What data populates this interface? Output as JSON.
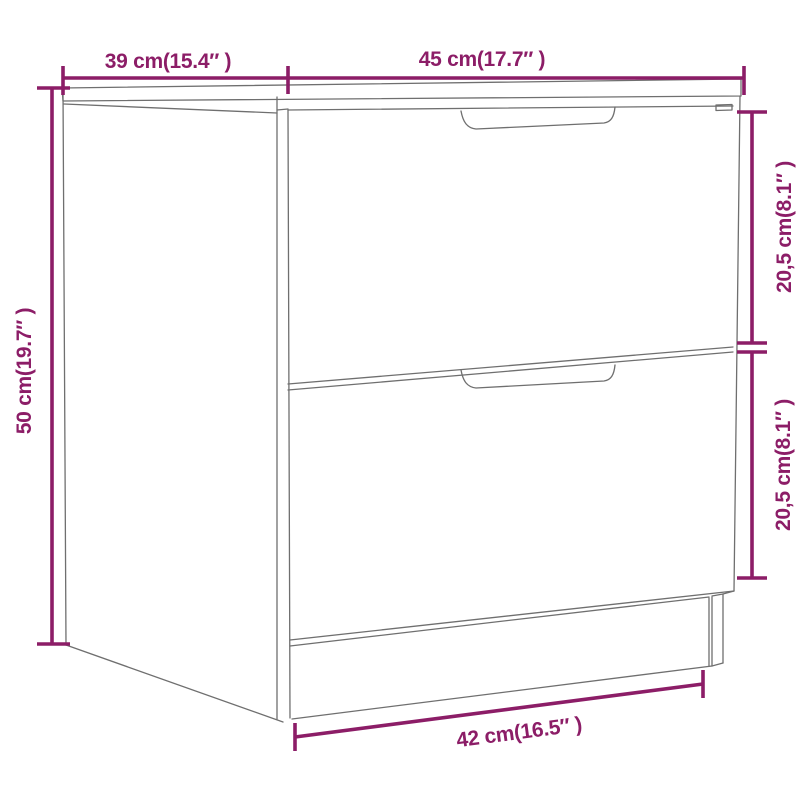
{
  "figure": {
    "subject": "two-drawer nightstand dimension diagram",
    "labels": {
      "top_depth": "39 cm(15.4″ )",
      "top_width": "45 cm(17.7″ )",
      "left_height": "50 cm(19.7″ )",
      "right_upper_drawer": "20,5 cm(8.1″ )",
      "right_lower_drawer": "20,5 cm(8.1″ )",
      "bottom_width": "42 cm(16.5″ )"
    },
    "colors": {
      "dimension_lines": "#8C1D67",
      "drawing_outline": "#6F6F6F",
      "background": "#FFFFFF"
    }
  }
}
